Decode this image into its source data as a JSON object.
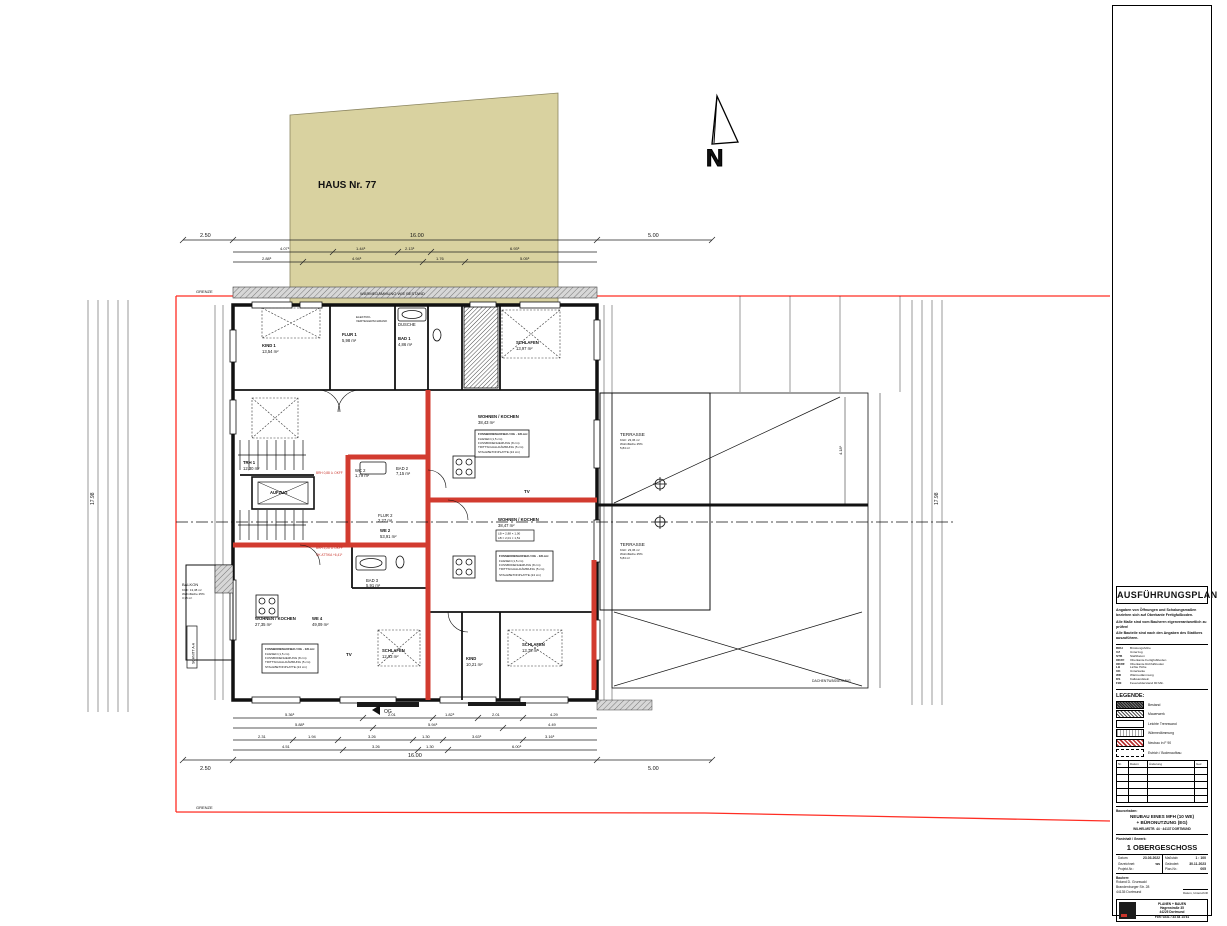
{
  "colors": {
    "beige": "#d9d2a0",
    "red_wall": "#d23b2f",
    "boundary_red": "#ff2d23",
    "line": "#111111",
    "gray_band": "#bdbdbd"
  },
  "site": {
    "haus_label": "HAUS Nr. 77",
    "north_label": "N",
    "boundary_top": "GRENZE",
    "boundary_bottom": "GRENZE",
    "section_label": "SCHNITT A-A",
    "roof_label": "DACHENTWÄSSERUNG",
    "og_marker": "OG"
  },
  "dims": {
    "top_left": "2.50",
    "top_mid": "16.00",
    "top_right": "5.00",
    "top_row2": [
      "4.07⁵",
      "1.44⁵",
      "2.13⁵",
      "6.93⁵"
    ],
    "top_row3": [
      "2.88⁵",
      "4.94⁵",
      "1.76",
      "5.05⁵"
    ],
    "bottom_row1": [
      "5.36⁵",
      "2.01",
      "1.82⁵",
      "2.01",
      "4.29"
    ],
    "bottom_row2": [
      "5.88⁵",
      "5.94⁵",
      "4.49"
    ],
    "bottom_row3": [
      "2.31",
      "1.94",
      "3.26",
      "1.30",
      "3.63⁵",
      "3.16⁵"
    ],
    "bottom_row4": [
      "4.51",
      "3.26",
      "1.30",
      "6.00⁵"
    ],
    "bottom_overall": "16.00",
    "bottom_left": "2.50",
    "bottom_right": "5.00",
    "left_overall": "17.98",
    "right_overall": "17.98",
    "terrace_v": "4.18⁵"
  },
  "plan": {
    "band_label": "WÄRMEDÄMMUNG WIE BESTAND",
    "elektro_l1": "ELEKTRO-",
    "elektro_l2": "VERTEILERSCHRANK",
    "tv": "TV",
    "rooms": [
      {
        "name": "KIND 1",
        "area": "13,54 m²"
      },
      {
        "name": "FLUR 1",
        "area": "5,98 m²"
      },
      {
        "name": "BAD 1",
        "area": "4,86 m²"
      },
      {
        "name": "DUSCHE",
        "area": ""
      },
      {
        "name": "SCHLAFEN",
        "area": "13,97 m²"
      },
      {
        "name": "WOHNEN / KOCHEN",
        "area": "38,43 m²"
      },
      {
        "name": "TRH 1",
        "area": "12,30 m²"
      },
      {
        "name": "AUFZUG",
        "area": ""
      },
      {
        "name": "WC 2",
        "area": "1,79 m²"
      },
      {
        "name": "BAD 2",
        "area": "7,15 m²"
      },
      {
        "name": "FLUR 2",
        "area": "2,27 m²"
      },
      {
        "name": "WE 2",
        "area": "53,91 m²"
      },
      {
        "name": "WOHNEN / KOCHEN",
        "area": "27,35 m²"
      },
      {
        "name": "WE 4",
        "area": "49,09 m²"
      },
      {
        "name": "BAD 3",
        "area": "5,91 m²"
      },
      {
        "name": "SCHLAFEN",
        "area": "12,93 m²"
      },
      {
        "name": "KIND",
        "area": "10,21 m²"
      },
      {
        "name": "SCHLAFEN",
        "area": "13,78 m²"
      },
      {
        "name": "WOHNEN / KOCHEN",
        "area": "38,47 m²"
      }
    ],
    "balkon": {
      "name": "BALKON",
      "l1": "KGF: 13,38 m²",
      "l2": "Wohnfläche 25%",
      "l3": "3,35 m²"
    },
    "terrasse1": {
      "name": "TERRASSE",
      "l1": "KGF: 23,36 m²",
      "l2": "Wohnfläche 25%",
      "l3": "5,84 m²"
    },
    "terrasse2": {
      "name": "TERRASSE",
      "l1": "KGF: 23,36 m²",
      "l2": "Wohnfläche 25%",
      "l3": "5,84 m²"
    },
    "floor_note": {
      "l1": "FUSSBODENAUFBAU OG · 1/8 cm:",
      "l2": "FLIESEN (1,5 cm)",
      "l3": "FUSSBODENHEIZUNG (8 cm)",
      "l4": "TRITTSCHALLDÄMMUNG (5 cm)",
      "l5": "STAHLBETONPLATTE (24 cm)"
    },
    "lb_note": {
      "l1": "LB = 2,88 × 1,00",
      "l2": "LB = 2,01 × 1,51"
    },
    "red_notes": [
      "BRH 0,88 ü. OKFF",
      "BRH 2,26 ü. OKFF",
      "OK ATTIKA +6,41⁵"
    ]
  },
  "titleblock": {
    "title": "AUSFÜHRUNGSPLAN",
    "notes": [
      "Angaben von Öffnungen und Schalungsmaßen beziehen sich auf Oberkante Fertigfußboden.",
      "Alle Maße sind vom Bauherrn eigenverantwortlich zu prüfen!",
      "Alle Bauteile sind nach den Angaben des Statikers auszuführen."
    ],
    "abbrev": [
      {
        "k": "BRH",
        "v": "Brüstungshöhe"
      },
      {
        "k": "UZ",
        "v": "Unterzug"
      },
      {
        "k": "STB",
        "v": "Stahlbeton"
      },
      {
        "k": "OKFF",
        "v": "Oberkante Fertigfußboden"
      },
      {
        "k": "OKRF",
        "v": "Oberkante Rohfußboden"
      },
      {
        "k": "LH",
        "v": "Lichte Höhe"
      },
      {
        "k": "UK",
        "v": "Unterkante"
      },
      {
        "k": "WD",
        "v": "Wärmedämmung"
      },
      {
        "k": "KS",
        "v": "Kalksandstein"
      },
      {
        "k": "F90",
        "v": "Feuerwiderstand 90 Min."
      }
    ],
    "legend_title": "LEGENDE:",
    "legend": [
      {
        "label": "Bestand"
      },
      {
        "label": "Mauerwerk"
      },
      {
        "label": "Leichte Trennwand"
      },
      {
        "label": "Wärmedämmung"
      },
      {
        "label": "Neubau in F 90"
      },
      {
        "label": "Estrich / Bodenaufbau"
      }
    ],
    "rev_headers": [
      "Nr.",
      "Datum",
      "Änderung",
      "Gez."
    ],
    "bauvorhaben_label": "Bauvorhaben:",
    "project_line1": "NEUBAU EINES MFH (10 WE)",
    "project_line2": "+ BÜRONUTZUNG (EG)",
    "project_line3": "WILHELMSTR. 44 · 44137 DORTMUND",
    "planinhalt_label": "Planinhalt / Gewerk:",
    "plan_title": "1 OBERGESCHOSS",
    "fields": {
      "datum_label": "Datum:",
      "datum": "23.03.2022",
      "gez_label": "Gezeichnet:",
      "gez": "ws",
      "proj_label": "Projekt-Nr.:",
      "proj": "",
      "massstab_label": "Maßstab:",
      "massstab": "1 : 100",
      "geaendert_label": "Geändert:",
      "geaendert": "30.11.2023",
      "plannr_label": "Plan-Nr.:",
      "plannr": "005"
    },
    "bauherr_label": "Bauherr:",
    "bauherr_l1": "Roland D. Grunwald",
    "bauherr_l2": "Brandenburger Str. 28",
    "bauherr_l3": "44135 Dortmund",
    "sign1": "Datum, Unterschrift",
    "sign2": "Datum, Unterschrift",
    "firm": {
      "name": "PLANEN + BAUEN",
      "line2": "Hagenstraße 35",
      "line3": "44225 Dortmund",
      "line4": "Fon: 0231 / 33 44 14 61"
    }
  }
}
